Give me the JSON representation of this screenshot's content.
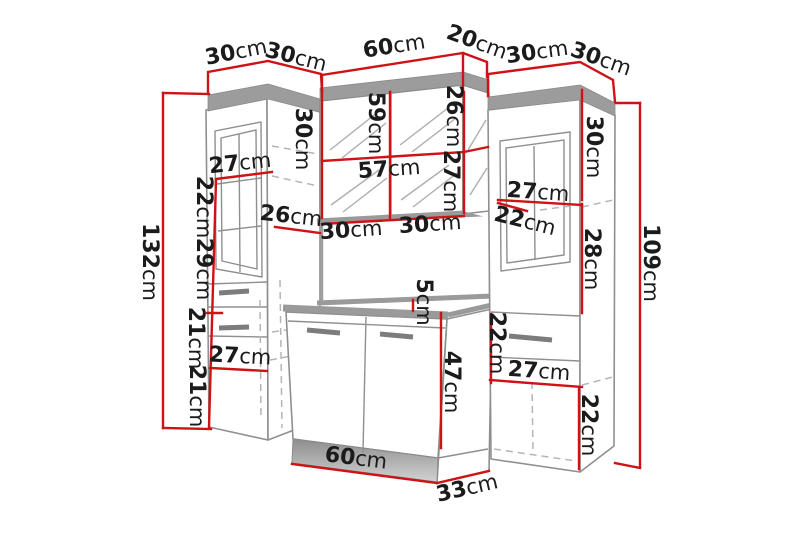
{
  "image": {
    "type": "furniture-dimension-diagram",
    "subject": "bathroom furniture set: left tall cabinet, mirror wall cabinet, vanity unit, right tall cabinet",
    "background": "#ffffff"
  },
  "colors": {
    "dimension_red": "#cd1316",
    "outline_gray": "#8f8f8f",
    "band_gray": "#9c9c9c",
    "hidden_dash_gray": "#b5b5b5",
    "handle_gray": "#7c7c7c",
    "label_black": "#1b1b1b"
  },
  "dimensions": {
    "unit": "cm",
    "labels": [
      {
        "value": "30",
        "unit": "cm"
      },
      {
        "value": "30",
        "unit": "cm"
      },
      {
        "value": "60",
        "unit": "cm"
      },
      {
        "value": "20",
        "unit": "cm"
      },
      {
        "value": "30",
        "unit": "cm"
      },
      {
        "value": "30",
        "unit": "cm"
      },
      {
        "value": "132",
        "unit": "cm"
      },
      {
        "value": "27",
        "unit": "cm"
      },
      {
        "value": "22",
        "unit": "cm"
      },
      {
        "value": "29",
        "unit": "cm"
      },
      {
        "value": "21",
        "unit": "cm"
      },
      {
        "value": "21",
        "unit": "cm"
      },
      {
        "value": "27",
        "unit": "cm"
      },
      {
        "value": "26",
        "unit": "cm"
      },
      {
        "value": "30",
        "unit": "cm"
      },
      {
        "value": "59",
        "unit": "cm"
      },
      {
        "value": "26",
        "unit": "cm"
      },
      {
        "value": "57",
        "unit": "cm"
      },
      {
        "value": "27",
        "unit": "cm"
      },
      {
        "value": "30",
        "unit": "cm"
      },
      {
        "value": "30",
        "unit": "cm"
      },
      {
        "value": "5",
        "unit": "cm"
      },
      {
        "value": "47",
        "unit": "cm"
      },
      {
        "value": "60",
        "unit": "cm"
      },
      {
        "value": "33",
        "unit": "cm"
      },
      {
        "value": "30",
        "unit": "cm"
      },
      {
        "value": "27",
        "unit": "cm"
      },
      {
        "value": "22",
        "unit": "cm"
      },
      {
        "value": "28",
        "unit": "cm"
      },
      {
        "value": "22",
        "unit": "cm"
      },
      {
        "value": "27",
        "unit": "cm"
      },
      {
        "value": "22",
        "unit": "cm"
      },
      {
        "value": "109",
        "unit": "cm"
      }
    ]
  }
}
